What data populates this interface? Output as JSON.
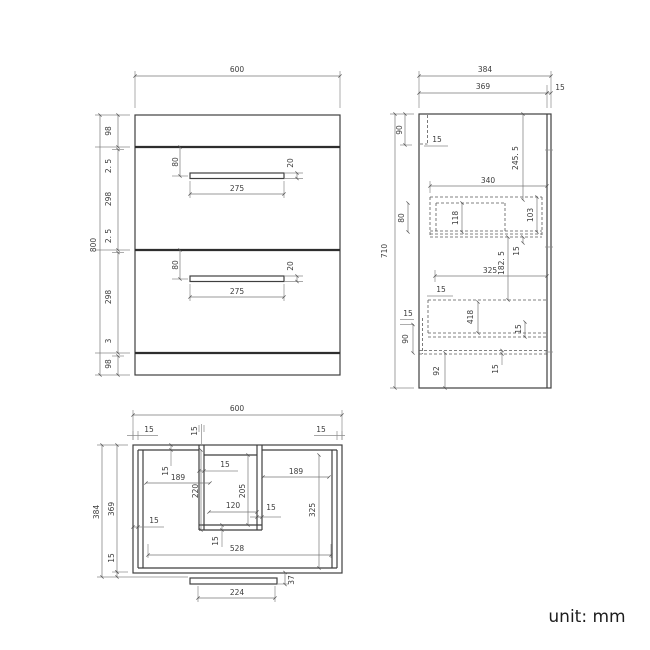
{
  "unit_label": "unit: mm",
  "front": {
    "width": "600",
    "height": "800",
    "seg_top": "98",
    "seg_gap1": "2. 5",
    "seg_drawer1": "298",
    "seg_gap2": "2. 5",
    "seg_drawer2": "298",
    "seg_gap3": "3",
    "seg_bottom": "98",
    "handle_offset": "80",
    "handle_height": "20",
    "handle_width": "275"
  },
  "side": {
    "depth": "384",
    "inner_depth": "369",
    "back_thickness": "15",
    "height": "710",
    "top_height": "90",
    "top_panel": "15",
    "drop_245": "245. 5",
    "drawer_depth_340": "340",
    "box_height_80": "80",
    "inner_height_118": "118",
    "inner_height_103": "103",
    "rail_15": "15",
    "drop_182": "182. 5",
    "drawer_depth_325": "325",
    "front_panel_15": "15",
    "inner_height_418": "418",
    "rail_15b": "15",
    "gap_15": "15",
    "low_90": "90",
    "plinth_92": "92",
    "bottom_15": "15"
  },
  "plan": {
    "width": "600",
    "wall_left_15": "15",
    "wall_mid_15": "15",
    "wall_right_15": "15",
    "depth": "384",
    "inner_depth": "369",
    "bottom_15": "15",
    "top_wall_15": "15",
    "bay_left_189": "189",
    "cut_depth_220": "220",
    "cut_wall_15": "15",
    "cut_depth_205": "205",
    "bay_right_189": "189",
    "cut_width_120": "120",
    "cut_wall_right_15": "15",
    "bay_depth_325": "325",
    "side_wall_15": "15",
    "cut_bottom_15": "15",
    "inner_width_528": "528",
    "plinth_37": "37",
    "plinth_224": "224"
  }
}
